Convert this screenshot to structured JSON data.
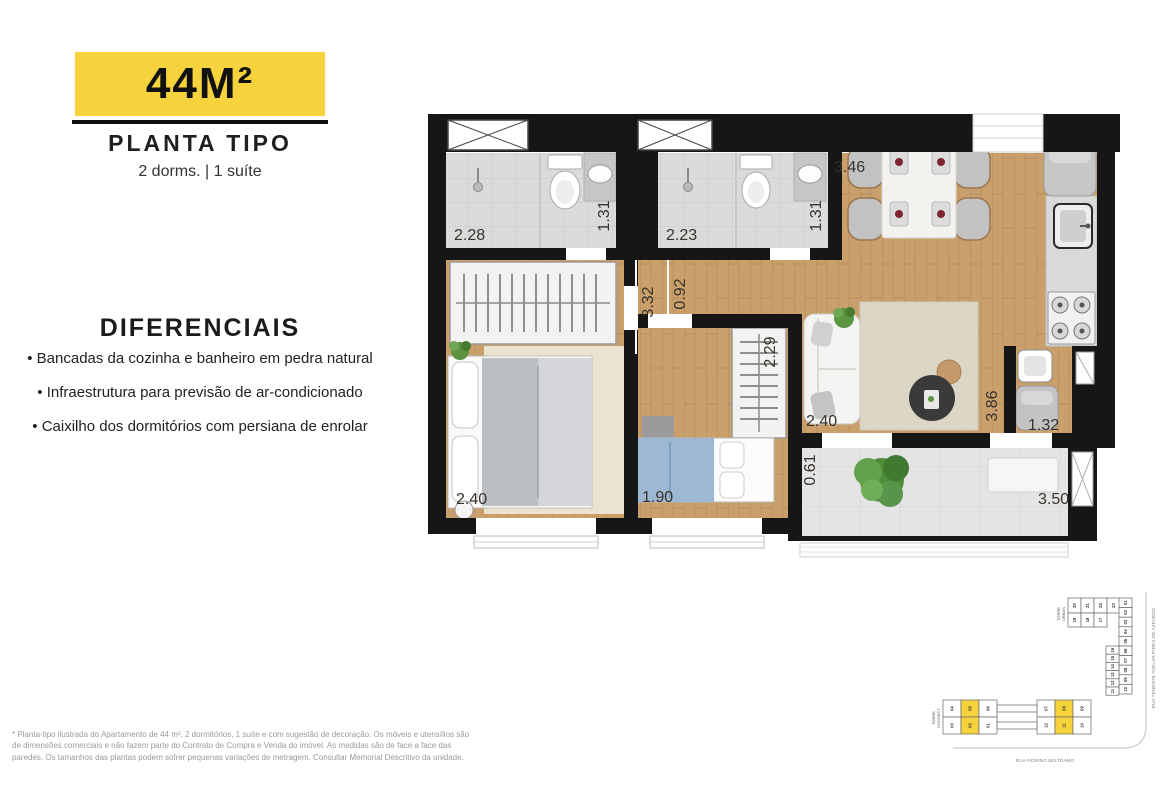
{
  "header": {
    "area_badge": "44M²",
    "plan_type": "PLANTA TIPO",
    "subtitle": "2 dorms. | 1 suíte"
  },
  "features": {
    "title": "DIFERENCIAIS",
    "items": [
      "Bancadas da cozinha e banheiro em pedra natural",
      "Infraestrutura para previsão de ar-condicionado",
      "Caixilho dos dormitórios com persiana de enrolar"
    ]
  },
  "disclaimer": "* Planta-tipo ilustrada do Apartamento de 44 m², 2 dormitórios, 1 suíte e com sugestão de decoração. Os móveis e utensílios são de dimensões comerciais e não fazem parte do Contrato de Compra e Venda do imóvel. As medidas são de face a face das paredes. Os tamanhos das plantas podem sofrer pequenas variações de metragem. Consultar Memorial Descritivo da unidade.",
  "floor_plan": {
    "dimensions": {
      "suite_bath_width": "2.28",
      "suite_bath_depth": "1.31",
      "bath2_width": "2.23",
      "bath2_depth": "1.31",
      "dining_width": "3.46",
      "hall_length": "3.32",
      "hall_width": "0.92",
      "suite_width": "2.40",
      "bedroom2_width": "1.90",
      "bedroom2_closet_depth": "2.29",
      "living_width": "2.40",
      "kitchen_length": "3.86",
      "laundry_width": "1.32",
      "balcony_depth": "0.61",
      "balcony_width": "3.50"
    }
  },
  "site_plan": {
    "highlight_color": "#F6D33C",
    "urban": {
      "line1": "TORRE",
      "line2": "URBAN",
      "arm_row1": [
        "20",
        "21",
        "22",
        "23"
      ],
      "arm_row2": [
        "19",
        "18",
        "17"
      ],
      "col_outer": [
        "01",
        "02",
        "03",
        "04",
        "05",
        "06",
        "07",
        "08",
        "09",
        "10"
      ],
      "col_inner": [
        "16",
        "15",
        "14",
        "13",
        "12",
        "11"
      ]
    },
    "connect": {
      "line1": "TORRE",
      "line2": "CONNECT",
      "left_top": [
        "04",
        "05",
        "06"
      ],
      "left_bottom": [
        "03",
        "02",
        "01"
      ],
      "right_top": [
        "07",
        "08",
        "09"
      ],
      "right_bottom": [
        "12",
        "11",
        "10"
      ],
      "highlighted": [
        "05",
        "02",
        "08",
        "11"
      ]
    },
    "streets": {
      "right": "RUA TENENTE AVELAR PIRES DE AZEVEDO",
      "bottom": "RUA FIORINO BELTRAMO"
    }
  },
  "colors": {
    "accent": "#F6D33C",
    "wall": "#161616",
    "wood": "#C99F6B",
    "tile": "#DBDBDB"
  }
}
